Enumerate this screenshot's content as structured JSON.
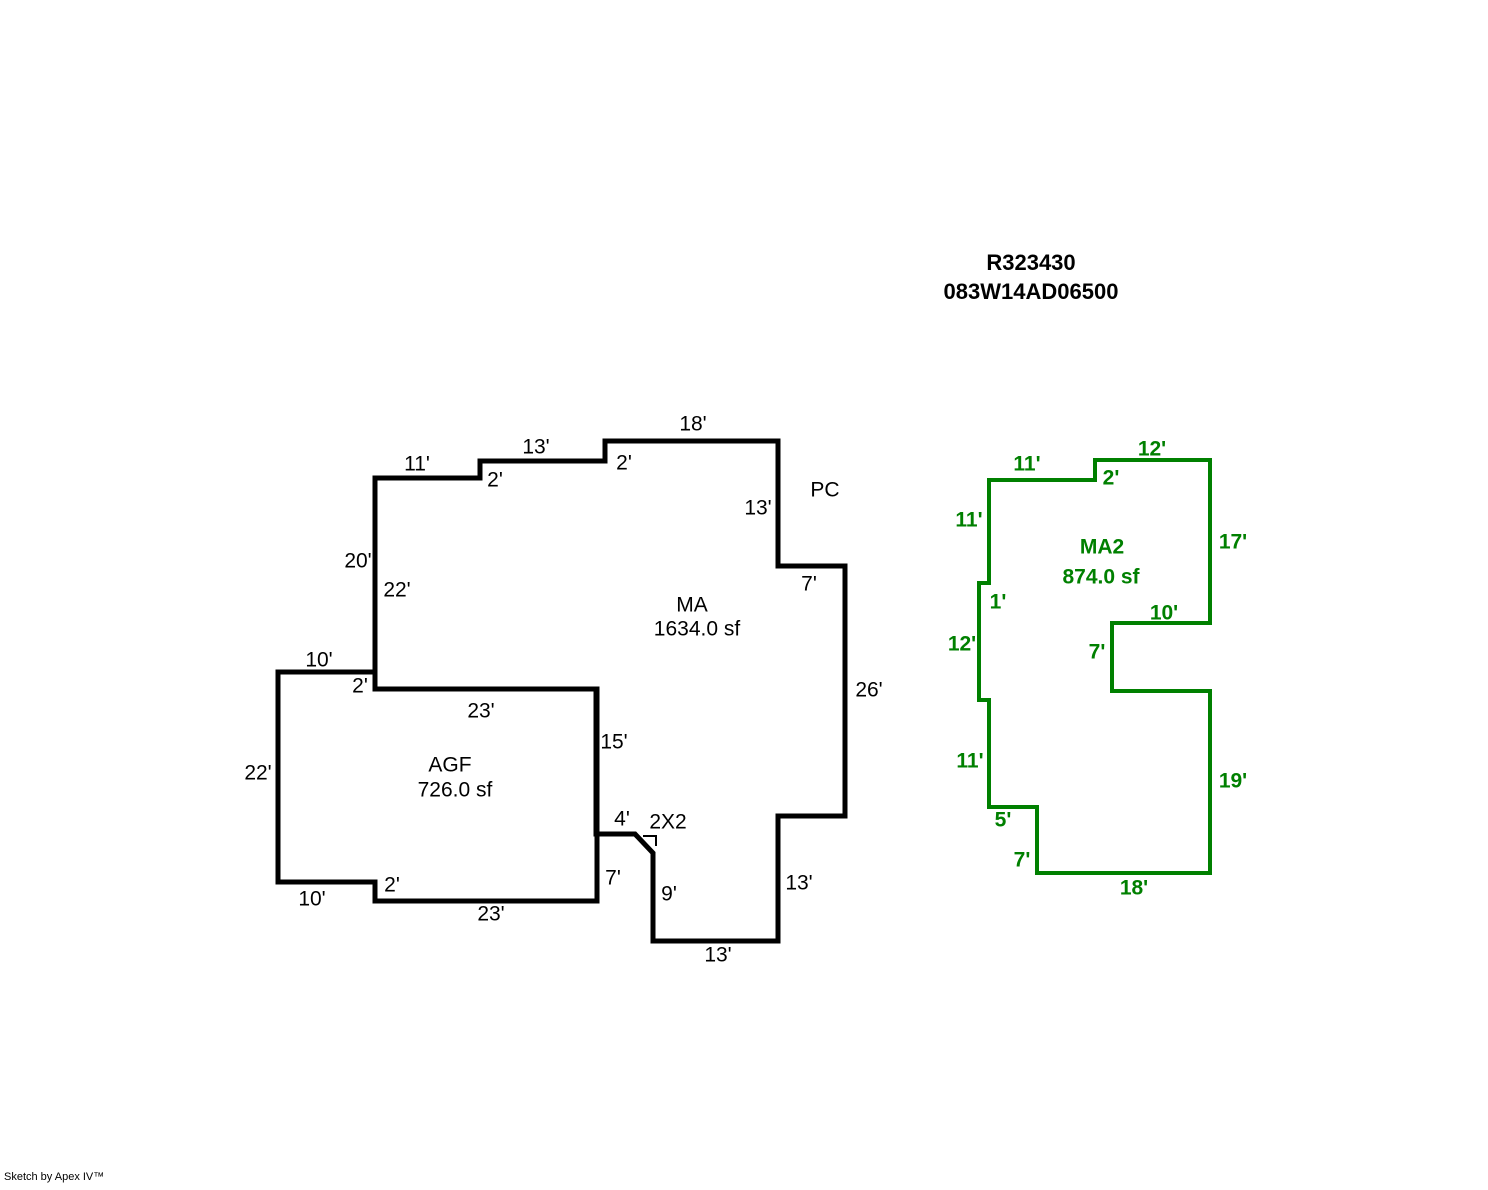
{
  "header": {
    "record_id": "R323430",
    "parcel_id": "083W14AD06500"
  },
  "footer": {
    "credit": "Sketch by Apex IV™"
  },
  "colors": {
    "primary": "#000000",
    "secondary": "#008000",
    "background": "#ffffff"
  },
  "sketch": {
    "width": 1488,
    "height": 1190,
    "shapes": [
      {
        "name": "ma-outline",
        "color": "#000000",
        "stroke_width": 5,
        "closed": true,
        "points": [
          [
            375,
            478
          ],
          [
            480,
            478
          ],
          [
            480,
            461
          ],
          [
            605,
            461
          ],
          [
            605,
            441
          ],
          [
            778,
            441
          ],
          [
            778,
            566
          ],
          [
            845,
            566
          ],
          [
            845,
            816
          ],
          [
            778,
            816
          ],
          [
            778,
            941
          ],
          [
            653,
            941
          ],
          [
            653,
            853
          ],
          [
            635,
            834
          ],
          [
            596,
            834
          ],
          [
            596,
            689
          ],
          [
            375,
            689
          ]
        ],
        "area_label": {
          "title": "MA",
          "area": "1634.0 sf",
          "title_x": 692,
          "title_y": 605,
          "area_x": 697,
          "area_y": 629,
          "color": "#000000",
          "bold": false
        }
      },
      {
        "name": "agf-outline",
        "color": "#000000",
        "stroke_width": 5,
        "closed": true,
        "points": [
          [
            278,
            672
          ],
          [
            375,
            672
          ],
          [
            375,
            689
          ],
          [
            597,
            689
          ],
          [
            597,
            901
          ],
          [
            375,
            901
          ],
          [
            375,
            882
          ],
          [
            278,
            882
          ]
        ],
        "area_label": {
          "title": "AGF",
          "area": "726.0 sf",
          "title_x": 450,
          "title_y": 765,
          "area_x": 455,
          "area_y": 790,
          "color": "#000000",
          "bold": false
        }
      },
      {
        "name": "ma2-outline",
        "color": "#008000",
        "stroke_width": 4,
        "closed": true,
        "points": [
          [
            989,
            480
          ],
          [
            1095,
            480
          ],
          [
            1095,
            460
          ],
          [
            1210,
            460
          ],
          [
            1210,
            623
          ],
          [
            1112,
            623
          ],
          [
            1112,
            691
          ],
          [
            1210,
            691
          ],
          [
            1210,
            873
          ],
          [
            1037,
            873
          ],
          [
            1037,
            807
          ],
          [
            989,
            807
          ],
          [
            989,
            700
          ],
          [
            979,
            700
          ],
          [
            979,
            583
          ],
          [
            989,
            583
          ]
        ],
        "area_label": {
          "title": "MA2",
          "area": "874.0 sf",
          "title_x": 1102,
          "title_y": 547,
          "area_x": 1101,
          "area_y": 577,
          "color": "#008000",
          "bold": true
        }
      },
      {
        "name": "angle-mark",
        "color": "#000000",
        "stroke_width": 2,
        "closed": false,
        "points": [
          [
            643,
            836
          ],
          [
            656,
            836
          ],
          [
            656,
            846
          ]
        ]
      }
    ],
    "labels": [
      {
        "kind": "dimension",
        "text": "11'",
        "x": 417,
        "y": 464,
        "color": "#000000",
        "bold": false
      },
      {
        "kind": "dimension",
        "text": "2'",
        "x": 495,
        "y": 480,
        "color": "#000000",
        "bold": false
      },
      {
        "kind": "dimension",
        "text": "13'",
        "x": 536,
        "y": 447,
        "color": "#000000",
        "bold": false
      },
      {
        "kind": "dimension",
        "text": "2'",
        "x": 624,
        "y": 463,
        "color": "#000000",
        "bold": false
      },
      {
        "kind": "dimension",
        "text": "18'",
        "x": 693,
        "y": 424,
        "color": "#000000",
        "bold": false
      },
      {
        "kind": "dimension",
        "text": "13'",
        "x": 758,
        "y": 508,
        "color": "#000000",
        "bold": false
      },
      {
        "kind": "annotation",
        "text": "PC",
        "x": 825,
        "y": 490,
        "color": "#000000",
        "bold": false
      },
      {
        "kind": "dimension",
        "text": "7'",
        "x": 809,
        "y": 584,
        "color": "#000000",
        "bold": false
      },
      {
        "kind": "dimension",
        "text": "26'",
        "x": 869,
        "y": 690,
        "color": "#000000",
        "bold": false
      },
      {
        "kind": "dimension",
        "text": "13'",
        "x": 799,
        "y": 883,
        "color": "#000000",
        "bold": false
      },
      {
        "kind": "dimension",
        "text": "13'",
        "x": 718,
        "y": 955,
        "color": "#000000",
        "bold": false
      },
      {
        "kind": "dimension",
        "text": "9'",
        "x": 669,
        "y": 894,
        "color": "#000000",
        "bold": false
      },
      {
        "kind": "annotation",
        "text": "2X2",
        "x": 668,
        "y": 822,
        "color": "#000000",
        "bold": false
      },
      {
        "kind": "dimension",
        "text": "4'",
        "x": 622,
        "y": 819,
        "color": "#000000",
        "bold": false
      },
      {
        "kind": "dimension",
        "text": "7'",
        "x": 613,
        "y": 878,
        "color": "#000000",
        "bold": false
      },
      {
        "kind": "dimension",
        "text": "15'",
        "x": 614,
        "y": 742,
        "color": "#000000",
        "bold": false
      },
      {
        "kind": "dimension",
        "text": "23'",
        "x": 481,
        "y": 711,
        "color": "#000000",
        "bold": false
      },
      {
        "kind": "dimension",
        "text": "20'",
        "x": 358,
        "y": 561,
        "color": "#000000",
        "bold": false
      },
      {
        "kind": "dimension",
        "text": "22'",
        "x": 397,
        "y": 590,
        "color": "#000000",
        "bold": false
      },
      {
        "kind": "dimension",
        "text": "10'",
        "x": 319,
        "y": 660,
        "color": "#000000",
        "bold": false
      },
      {
        "kind": "dimension",
        "text": "2'",
        "x": 360,
        "y": 686,
        "color": "#000000",
        "bold": false
      },
      {
        "kind": "dimension",
        "text": "22'",
        "x": 258,
        "y": 773,
        "color": "#000000",
        "bold": false
      },
      {
        "kind": "dimension",
        "text": "10'",
        "x": 312,
        "y": 899,
        "color": "#000000",
        "bold": false
      },
      {
        "kind": "dimension",
        "text": "2'",
        "x": 392,
        "y": 885,
        "color": "#000000",
        "bold": false
      },
      {
        "kind": "dimension",
        "text": "23'",
        "x": 491,
        "y": 914,
        "color": "#000000",
        "bold": false
      },
      {
        "kind": "dimension",
        "text": "11'",
        "x": 1027,
        "y": 464,
        "color": "#008000",
        "bold": true
      },
      {
        "kind": "dimension",
        "text": "2'",
        "x": 1111,
        "y": 478,
        "color": "#008000",
        "bold": true
      },
      {
        "kind": "dimension",
        "text": "12'",
        "x": 1152,
        "y": 449,
        "color": "#008000",
        "bold": true
      },
      {
        "kind": "dimension",
        "text": "11'",
        "x": 969,
        "y": 520,
        "color": "#008000",
        "bold": true
      },
      {
        "kind": "dimension",
        "text": "17'",
        "x": 1233,
        "y": 542,
        "color": "#008000",
        "bold": true
      },
      {
        "kind": "dimension",
        "text": "1'",
        "x": 998,
        "y": 602,
        "color": "#008000",
        "bold": true
      },
      {
        "kind": "dimension",
        "text": "10'",
        "x": 1164,
        "y": 613,
        "color": "#008000",
        "bold": true
      },
      {
        "kind": "dimension",
        "text": "7'",
        "x": 1097,
        "y": 652,
        "color": "#008000",
        "bold": true
      },
      {
        "kind": "dimension",
        "text": "12'",
        "x": 962,
        "y": 644,
        "color": "#008000",
        "bold": true
      },
      {
        "kind": "dimension",
        "text": "11'",
        "x": 970,
        "y": 761,
        "color": "#008000",
        "bold": true
      },
      {
        "kind": "dimension",
        "text": "5'",
        "x": 1003,
        "y": 820,
        "color": "#008000",
        "bold": true
      },
      {
        "kind": "dimension",
        "text": "7'",
        "x": 1022,
        "y": 860,
        "color": "#008000",
        "bold": true
      },
      {
        "kind": "dimension",
        "text": "18'",
        "x": 1134,
        "y": 888,
        "color": "#008000",
        "bold": true
      },
      {
        "kind": "dimension",
        "text": "19'",
        "x": 1233,
        "y": 781,
        "color": "#008000",
        "bold": true
      }
    ]
  }
}
